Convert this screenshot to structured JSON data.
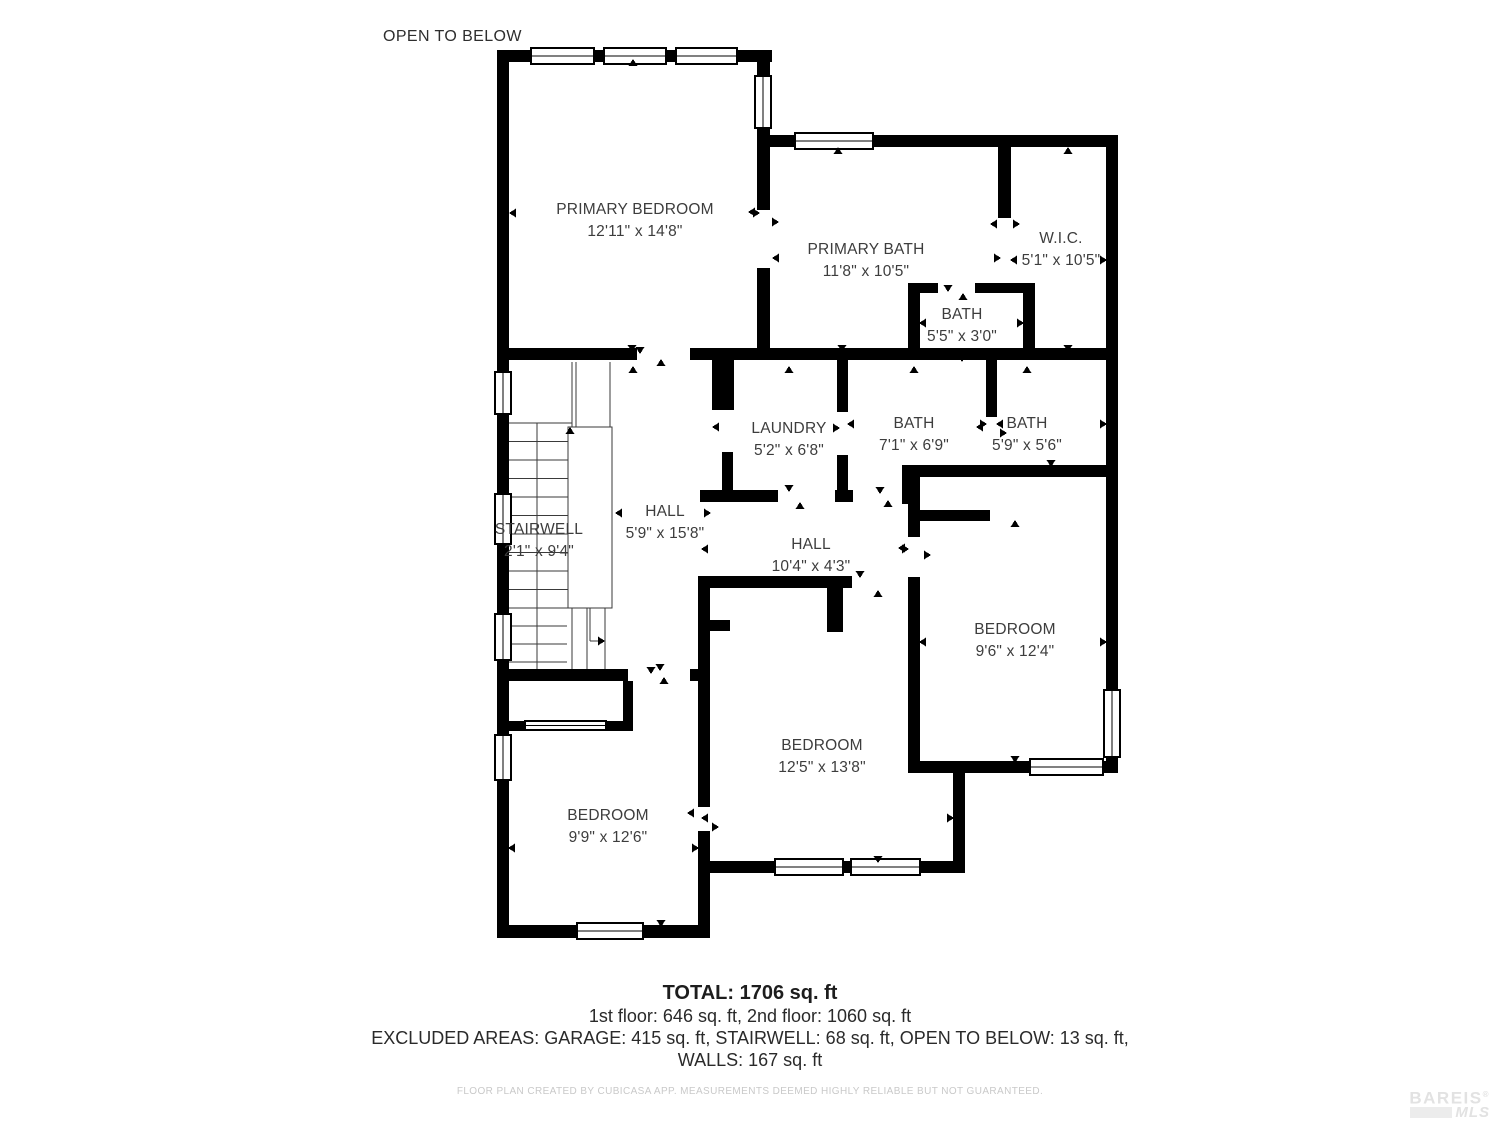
{
  "plan": {
    "open_to_below_label": "OPEN TO BELOW",
    "rooms": [
      {
        "id": "primary-bedroom",
        "name": "PRIMARY BEDROOM",
        "dims": "12'11\" x 14'8\""
      },
      {
        "id": "primary-bath",
        "name": "PRIMARY BATH",
        "dims": "11'8\" x 10'5\""
      },
      {
        "id": "wic",
        "name": "W.I.C.",
        "dims": "5'1\" x 10'5\""
      },
      {
        "id": "bath-small",
        "name": "BATH",
        "dims": "5'5\" x 3'0\""
      },
      {
        "id": "laundry",
        "name": "LAUNDRY",
        "dims": "5'2\" x 6'8\""
      },
      {
        "id": "bath-center",
        "name": "BATH",
        "dims": "7'1\" x 6'9\""
      },
      {
        "id": "bath-right",
        "name": "BATH",
        "dims": "5'9\" x 5'6\""
      },
      {
        "id": "stairwell",
        "name": "STAIRWELL",
        "dims": "2'1\" x 9'4\""
      },
      {
        "id": "hall-vertical",
        "name": "HALL",
        "dims": "5'9\" x 15'8\""
      },
      {
        "id": "hall-horizontal",
        "name": "HALL",
        "dims": "10'4\" x 4'3\""
      },
      {
        "id": "bedroom-right",
        "name": "BEDROOM",
        "dims": "9'6\" x 12'4\""
      },
      {
        "id": "bedroom-center",
        "name": "BEDROOM",
        "dims": "12'5\" x 13'8\""
      },
      {
        "id": "bedroom-left",
        "name": "BEDROOM",
        "dims": "9'9\" x 12'6\""
      }
    ],
    "summary": {
      "total": "TOTAL: 1706 sq. ft",
      "floors": "1st floor: 646 sq. ft, 2nd floor: 1060 sq. ft",
      "excluded": "EXCLUDED AREAS: GARAGE: 415 sq. ft, STAIRWELL: 68 sq. ft, OPEN TO BELOW: 13 sq. ft,",
      "walls": "WALLS: 167 sq. ft"
    },
    "disclaimer": "FLOOR PLAN CREATED BY CUBICASA APP. MEASUREMENTS DEEMED HIGHLY RELIABLE BUT NOT GUARANTEED.",
    "logo": {
      "line1": "BAREIS",
      "registered": "®",
      "line2": "MLS"
    },
    "colors": {
      "wall": "#000000",
      "text": "#3d3d3d",
      "muted": "#c9c9c9",
      "logo": "#e2e2e2"
    }
  }
}
